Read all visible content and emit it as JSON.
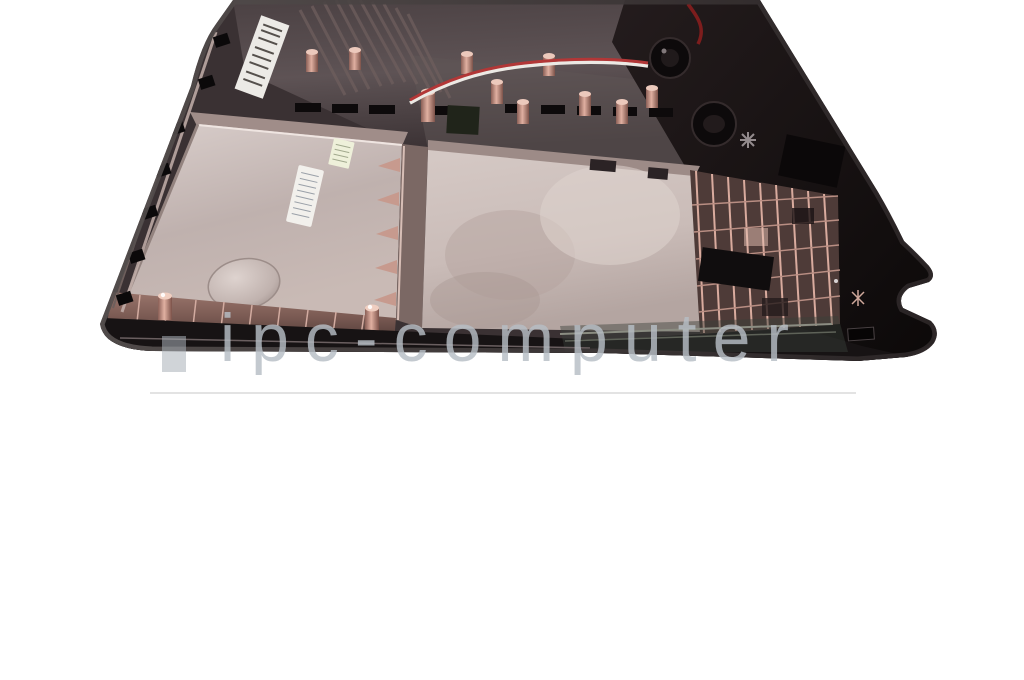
{
  "watermark": {
    "text": "ipc-computer"
  },
  "colors": {
    "background": "#ffffff",
    "watermark-text": "#b7bec5",
    "watermark-bar": "#aab1b8",
    "underline": "#e3e3e3",
    "case-black": "#171213",
    "case-dark": "#3a3133",
    "panel-light": "#cfc3bf",
    "panel-mid": "#b5a7a4",
    "copper": "#c99a8c",
    "copper-dark": "#7c5a52",
    "wire-red": "#b23737",
    "wire-white": "#ece9e4",
    "sticker": "#f2f0ec"
  }
}
